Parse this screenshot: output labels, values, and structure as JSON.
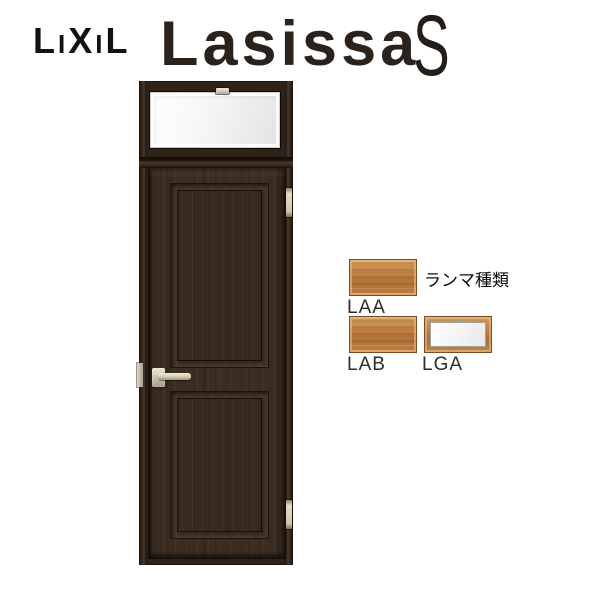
{
  "header": {
    "brand": "LIXIL",
    "brand_letters": [
      "L",
      "I",
      "X",
      "I",
      "L"
    ],
    "product": "Lasissa",
    "series": "S"
  },
  "annotation": {
    "title": "ランマ種類",
    "swatches": [
      {
        "code": "LAA",
        "style": "wood"
      },
      {
        "code": "LAB",
        "style": "wood"
      },
      {
        "code": "LGA",
        "style": "glass"
      }
    ]
  },
  "colors": {
    "background": "#ffffff",
    "brand_text": "#16110d",
    "logo_text": "#2a221b",
    "door_frame": "#2f2217",
    "door_wood": "#3c2d22",
    "panel_wood": "#392a1f",
    "glass": "#f2f2f3",
    "metal_hardware": "#cdc5ae",
    "swatch_wood": "#bd7c40",
    "swatch_border": "#7c4e1f",
    "label_text": "#2f2d2a"
  }
}
